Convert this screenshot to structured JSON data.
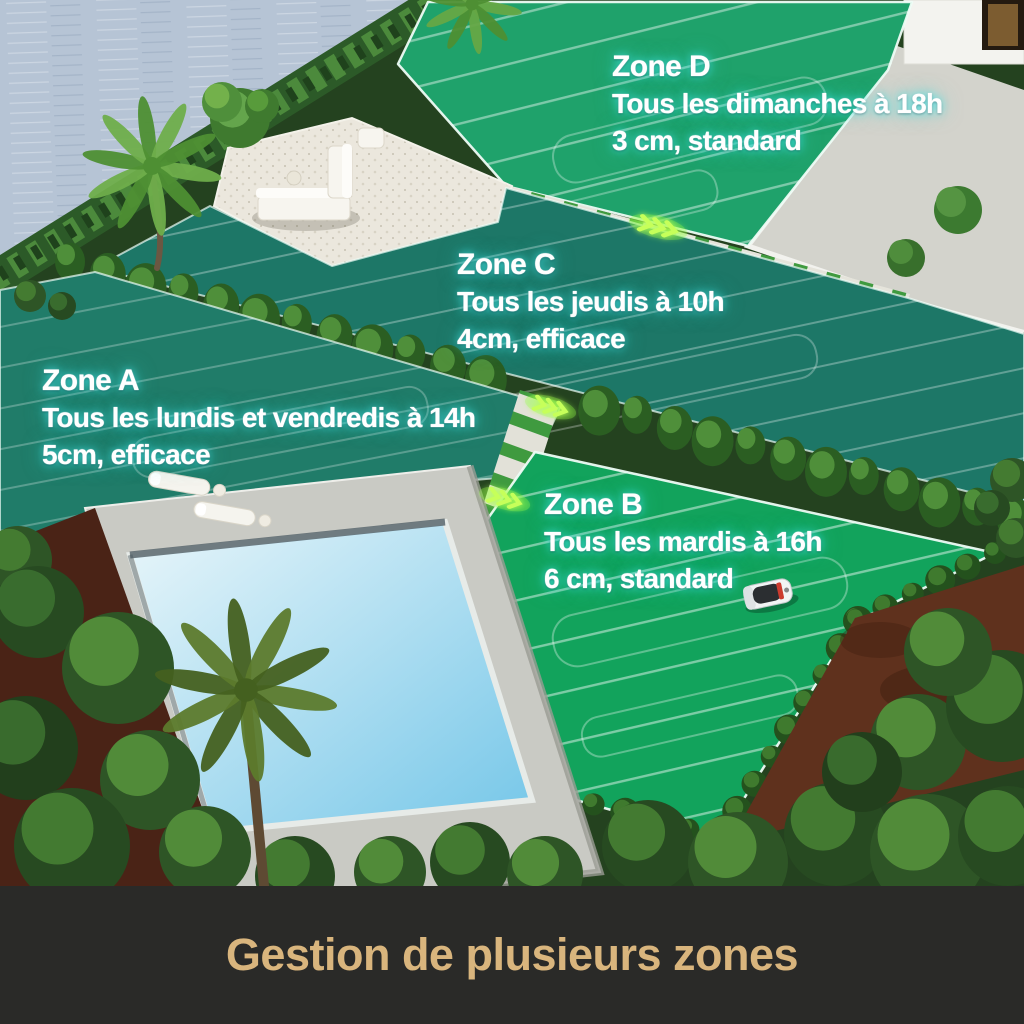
{
  "banner": {
    "title": "Gestion de plusieurs zones"
  },
  "zones": [
    {
      "name": "Zone A",
      "schedule": "Tous les lundis et vendredis à 14h",
      "cut": "5cm, efficace"
    },
    {
      "name": "Zone B",
      "schedule": "Tous les mardis à 16h",
      "cut": "6 cm, standard"
    },
    {
      "name": "Zone C",
      "schedule": "Tous les jeudis à 10h",
      "cut": "4cm, efficace"
    },
    {
      "name": "Zone D",
      "schedule": "Tous les dimanches à 18h",
      "cut": "3 cm, standard"
    }
  ],
  "icons": {
    "robot_mower": "robot-mower-icon",
    "direction_chevrons": "path-direction-chevrons-icon",
    "pool": "swimming-pool",
    "sun_loungers": "sun-loungers",
    "outdoor_sofa": "outdoor-sofa-set"
  },
  "colors": {
    "label_text": "#ffffff",
    "label_glow": "#3fe3e4",
    "banner_bg": "#2a2a28",
    "banner_text": "#d9b57d",
    "grass_bright": "#1fa26b",
    "grass_teal": "#1d7767",
    "grass_vivid": "#12a35c",
    "pool_water": "#8fd0ea",
    "chevron_glow": "#c6ff5a",
    "water": "#b6c4d5"
  }
}
